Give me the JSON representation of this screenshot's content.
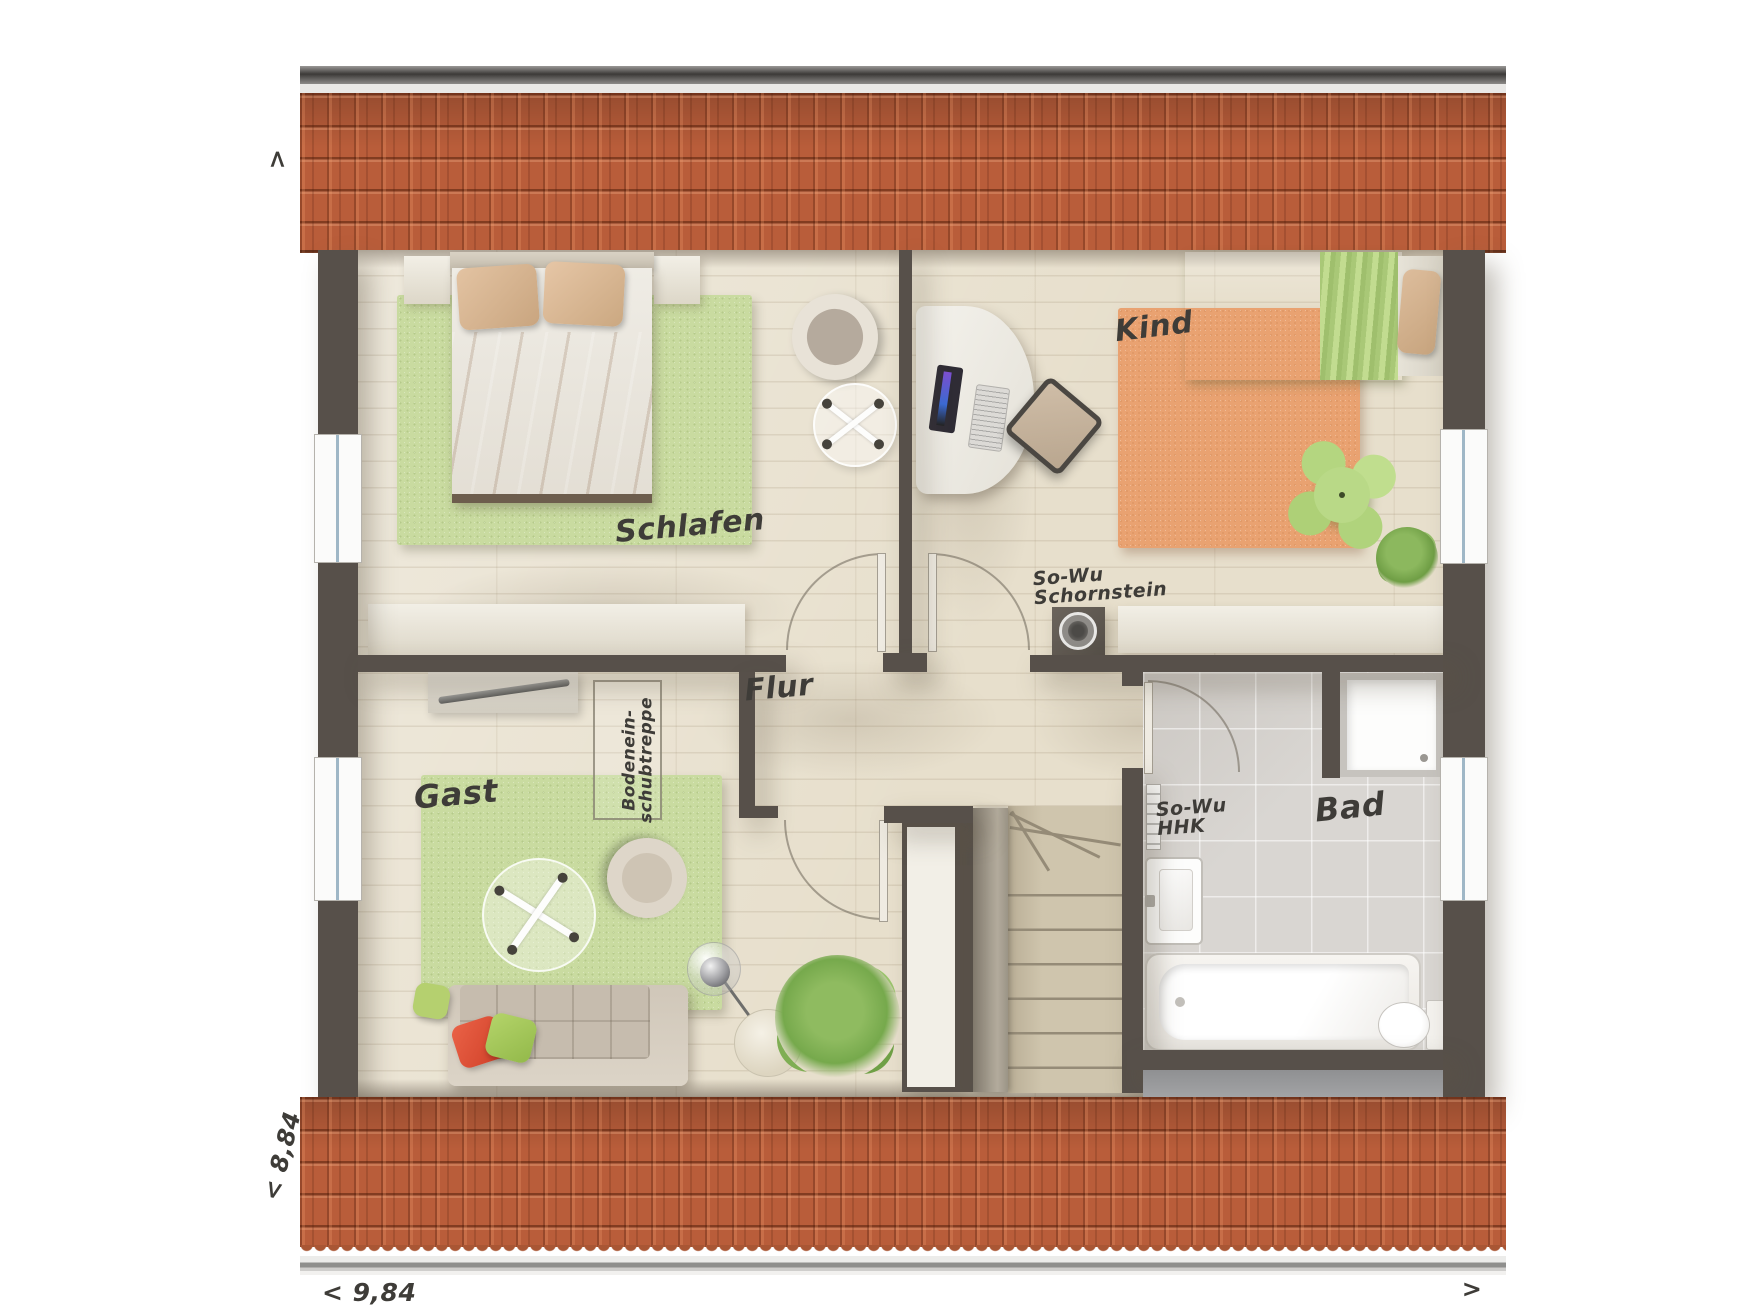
{
  "plan": {
    "title": "Dachgeschoss Grundriss",
    "labels": {
      "schlafen": "Schlafen",
      "kind": "Kind",
      "gast": "Gast",
      "flur": "Flur",
      "bad": "Bad"
    },
    "annotations": {
      "chimney_line1": "So-Wu",
      "chimney_line2": "Schornstein",
      "hhk_line1": "So-Wu",
      "hhk_line2": "HHK",
      "attic_line1": "Bodenein-",
      "attic_line2": "schubtreppe"
    },
    "dimensions": {
      "width_bottom": "< 9,84",
      "depth_left": "< 8,84",
      "arrow_top_left": ">",
      "arrow_bottom_right": ">"
    },
    "colors": {
      "roof_tile": "#b95d3a",
      "wall": "#57504a",
      "wood_floor": "#e7dfcc",
      "bath_tile": "#d9d6d2",
      "rug_green": "#c9dba0",
      "rug_orange": "#e9a271",
      "pillow_red": "#e05338",
      "pillow_green": "#a8c95e"
    }
  }
}
